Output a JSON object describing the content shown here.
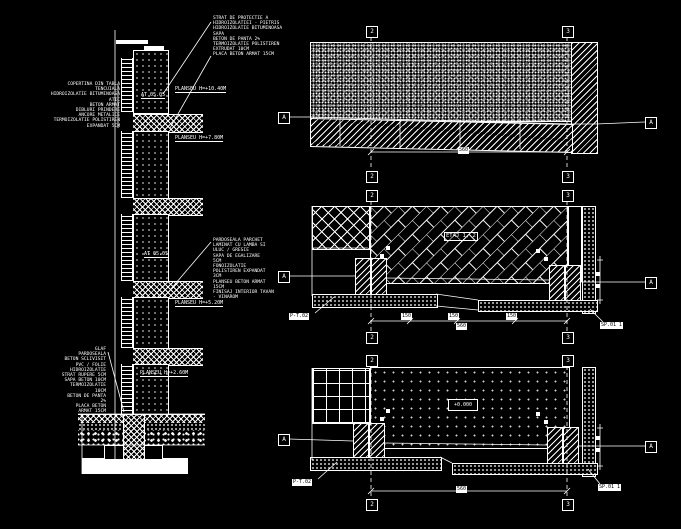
{
  "colors": {
    "background": "#000000",
    "line": "#ffffff",
    "stipple_gray": "#9a9a9a"
  },
  "section": {
    "levels": [
      "PLANSEU H=+10.40M",
      "PLANSEU H=+7.80M",
      "PLANSEU H=+5.20M",
      "PLANSEU H=+2.60M"
    ],
    "wall_refs": [
      "AT 05.05",
      "AT 05.05"
    ],
    "roof_notes": [
      "STRAT DE PROTECTIE A",
      "HIDROIZOLATIEI - PIETRIS",
      "HIDROIZOLATIE BITUMINOASA",
      "SAPA",
      "BETON DE PANTA 2%",
      "TERMOIZOLATIE POLISTIREN",
      "EXTRUDAT 10CM",
      "PLACA BETON ARMAT 15CM"
    ],
    "parapet_notes": [
      "COPERTINA DIN TABLA",
      "TENCUIALA",
      "HIDROIZOLATIE BITUMINOASA",
      "ATIC",
      "BETON ARMAT",
      "DIBLURI PRINDERE",
      "ANCORE METALICE",
      "TERMOIZOLATIE POLISTIREN",
      "EXPANDAT 5CM"
    ],
    "floor_notes": [
      "PARDOSEALA PARCHET",
      "LAMINAT CU LAMBA SI",
      "ULUC / GRESIE",
      "SAPA DE EGALIZARE",
      "5CM",
      "FONOIZOLATIE",
      "POLISTIREN EXPANDAT",
      "3CM",
      "PLANSEU BETON ARMAT",
      "15CM",
      "FINISAJ INTERIOR TAVAN",
      "- VINAROM"
    ],
    "ground_notes": [
      "GLAF",
      "PARDOSEALA",
      "BETON SCLIVISIT",
      "PVC / FOLIE",
      "HIDROIZOLATIE",
      "STRAT RUPERE 5CM",
      "SAPA BETON 10CM",
      "TERMOIZOLATIE",
      "10CM",
      "BETON DE PANTA",
      "2%",
      "PLACA BETON",
      "ARMAT 15CM"
    ]
  },
  "plans": {
    "grid_left": "2",
    "grid_right": "3",
    "section_marker": "A",
    "top": {
      "dim_total": "560"
    },
    "middle": {
      "title": "ETAJ 1, 2",
      "dims": [
        "150",
        "150",
        "150"
      ],
      "dim_total": "560",
      "ref_left": "P-T.02",
      "ref_right": "SP.01  1"
    },
    "bottom": {
      "level": "+0.000",
      "dim_total": "560",
      "ref_left": "P-T.02",
      "ref_right": "SP.01  1"
    }
  }
}
